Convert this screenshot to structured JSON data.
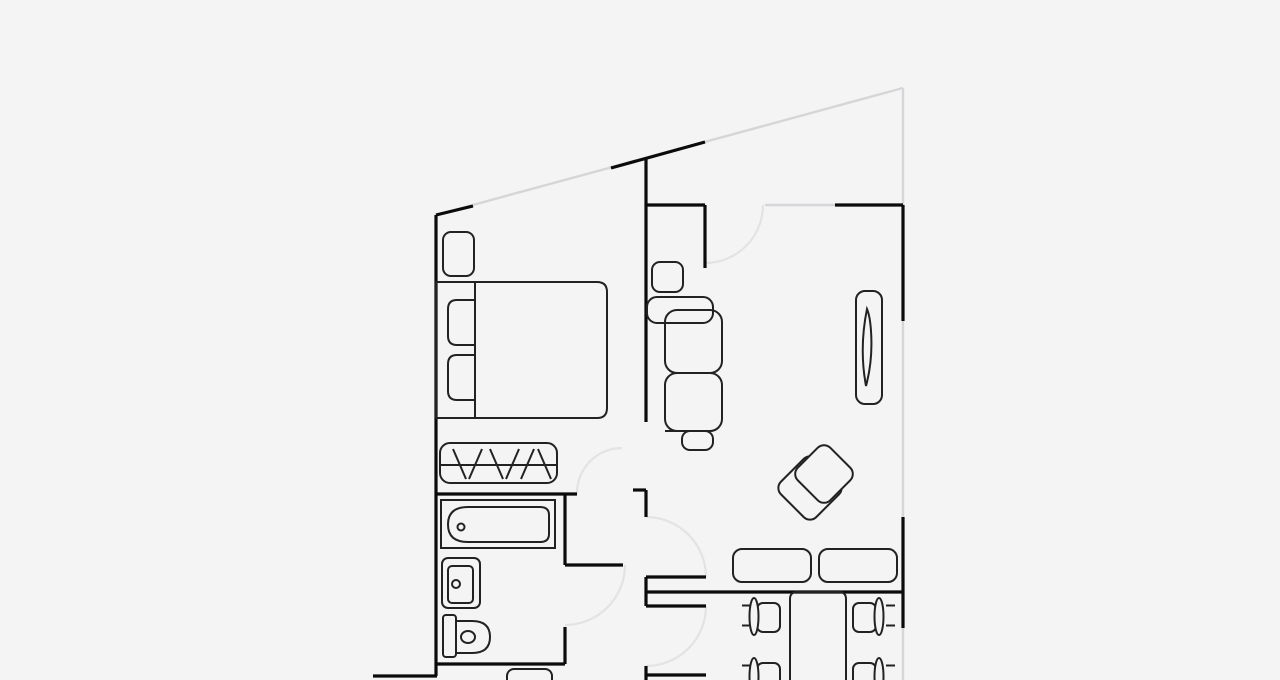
{
  "canvas": {
    "width": 1280,
    "height": 680,
    "background": "#f4f4f5"
  },
  "palette": {
    "wall": "#0b0b0b",
    "furniture": "#222222",
    "window": "#d6d6d9",
    "door_arc": "#e3e3e5",
    "wall_width": 3.2,
    "furniture_width": 2,
    "window_width": 2.4,
    "arc_width": 2.2
  },
  "floorplan": {
    "walls": [
      [
        436,
        215,
        436,
        676
      ],
      [
        373,
        676,
        437,
        676
      ],
      [
        436,
        215,
        473,
        206
      ],
      [
        611,
        168,
        705,
        142
      ],
      [
        646,
        158,
        646,
        422
      ],
      [
        646,
        205,
        705,
        205
      ],
      [
        705,
        205,
        705,
        268
      ],
      [
        835,
        205,
        903,
        205
      ],
      [
        903,
        205,
        903,
        321
      ],
      [
        903,
        517,
        903,
        628
      ],
      [
        436,
        494,
        577,
        494
      ],
      [
        633,
        490,
        646,
        490
      ],
      [
        646,
        490,
        646,
        517
      ],
      [
        565,
        494,
        565,
        565
      ],
      [
        565,
        565,
        623,
        565
      ],
      [
        565,
        627,
        565,
        664
      ],
      [
        436,
        664,
        565,
        664
      ],
      [
        646,
        577,
        646,
        606
      ],
      [
        646,
        577,
        706,
        577
      ],
      [
        646,
        592,
        903,
        592
      ],
      [
        646,
        606,
        706,
        606
      ],
      [
        646,
        666,
        646,
        680
      ],
      [
        646,
        675,
        706,
        675
      ]
    ],
    "windows": [
      [
        436,
        215,
        903,
        88
      ],
      [
        903,
        88,
        903,
        680
      ],
      [
        765,
        205,
        835,
        205
      ]
    ],
    "door_arcs": [
      {
        "name": "bedroom-door-swing",
        "sx": 577,
        "sy": 493,
        "ex": 622,
        "ey": 448,
        "r": 45
      },
      {
        "name": "bathroom-door-swing",
        "sx": 625,
        "sy": 565,
        "ex": 565,
        "ey": 625,
        "r": 60
      },
      {
        "name": "living-room-door-swing",
        "sx": 763,
        "sy": 205,
        "ex": 705,
        "ey": 263,
        "r": 58
      },
      {
        "name": "hall-living-door-swing",
        "sx": 646,
        "sy": 517,
        "ex": 706,
        "ey": 577,
        "r": 60
      },
      {
        "name": "hall-dining-door-swing",
        "sx": 706,
        "sy": 606,
        "ex": 646,
        "ey": 666,
        "r": 60
      }
    ],
    "furniture": [
      {
        "name": "nightstand",
        "shapes": [
          {
            "k": "rect",
            "x": 443,
            "y": 232,
            "w": 31,
            "h": 44,
            "rx": 8
          }
        ]
      },
      {
        "name": "double-bed",
        "shapes": [
          {
            "k": "path",
            "d": "M436 282 H597 Q607 282 607 292 V408 Q607 418 597 418 H436 Z"
          },
          {
            "k": "line",
            "x1": 475,
            "y1": 282,
            "x2": 475,
            "y2": 418
          }
        ]
      },
      {
        "name": "pillow-1",
        "shapes": [
          {
            "k": "path",
            "d": "M475 300 H457 Q448 300 448 309 V336 Q448 345 457 345 H475 Z"
          }
        ]
      },
      {
        "name": "pillow-2",
        "shapes": [
          {
            "k": "path",
            "d": "M475 355 H457 Q448 355 448 364 V391 Q448 400 457 400 H475 Z"
          }
        ]
      },
      {
        "name": "closet-with-hangers",
        "shapes": [
          {
            "k": "rect",
            "x": 440,
            "y": 443,
            "w": 117,
            "h": 40,
            "rx": 10
          },
          {
            "k": "line",
            "x1": 440,
            "y1": 465,
            "x2": 557,
            "y2": 465
          },
          {
            "k": "line",
            "x1": 453,
            "y1": 449,
            "x2": 466,
            "y2": 479
          },
          {
            "k": "line",
            "x1": 482,
            "y1": 449,
            "x2": 469,
            "y2": 479
          },
          {
            "k": "line",
            "x1": 490,
            "y1": 449,
            "x2": 503,
            "y2": 479
          },
          {
            "k": "line",
            "x1": 519,
            "y1": 449,
            "x2": 506,
            "y2": 479
          },
          {
            "k": "line",
            "x1": 534,
            "y1": 449,
            "x2": 521,
            "y2": 479
          },
          {
            "k": "line",
            "x1": 538,
            "y1": 449,
            "x2": 551,
            "y2": 479
          }
        ]
      },
      {
        "name": "bathtub",
        "shapes": [
          {
            "k": "rect",
            "x": 441,
            "y": 500,
            "w": 114,
            "h": 48
          },
          {
            "k": "path",
            "d": "M468 507 H540 Q549 507 549 515 V534 Q549 542 540 542 H468 Q448 542 448 524.5 Q448 507 468 507 Z"
          },
          {
            "k": "circle",
            "cx": 461,
            "cy": 527,
            "r": 3.5
          }
        ]
      },
      {
        "name": "sink",
        "shapes": [
          {
            "k": "rect",
            "x": 442,
            "y": 558,
            "w": 38,
            "h": 50,
            "rx": 6
          },
          {
            "k": "rect",
            "x": 448,
            "y": 566,
            "w": 25,
            "h": 37,
            "rx": 4
          },
          {
            "k": "circle",
            "cx": 456,
            "cy": 584,
            "r": 4
          }
        ]
      },
      {
        "name": "toilet",
        "shapes": [
          {
            "k": "rect",
            "x": 443,
            "y": 615,
            "w": 13,
            "h": 42,
            "rx": 3
          },
          {
            "k": "path",
            "d": "M456 621 H472 Q490 621 490 637 Q490 653 472 653 H456 Z"
          },
          {
            "k": "ellipse",
            "cx": 468,
            "cy": 637,
            "rx": 7,
            "ry": 6
          }
        ]
      },
      {
        "name": "washing-machine",
        "shapes": [
          {
            "k": "rect",
            "x": 507,
            "y": 669,
            "w": 45,
            "h": 25,
            "rx": 7
          }
        ]
      },
      {
        "name": "sofa-side-table",
        "shapes": [
          {
            "k": "rect",
            "x": 652,
            "y": 262,
            "w": 31,
            "h": 30,
            "rx": 8
          }
        ]
      },
      {
        "name": "sofa",
        "shapes": [
          {
            "k": "rect",
            "x": 647,
            "y": 297,
            "w": 66,
            "h": 26,
            "rx": 10
          },
          {
            "k": "rect",
            "x": 665,
            "y": 310,
            "w": 57,
            "h": 63,
            "rx": 12
          },
          {
            "k": "rect",
            "x": 665,
            "y": 373,
            "w": 57,
            "h": 58,
            "rx": 12
          },
          {
            "k": "line",
            "x1": 665,
            "y1": 431,
            "x2": 683,
            "y2": 431
          },
          {
            "k": "rect",
            "x": 682,
            "y": 431,
            "w": 31,
            "h": 19,
            "rx": 8
          }
        ]
      },
      {
        "name": "tv-stand",
        "shapes": [
          {
            "k": "rect",
            "x": 856,
            "y": 291,
            "w": 26,
            "h": 113,
            "rx": 9
          },
          {
            "k": "path",
            "d": "M867 309 Q859 348 866 386 Q873 360 871 331 Q870 316 867 309 Z"
          }
        ]
      },
      {
        "name": "armchair",
        "shapes": [
          {
            "k": "rotrect",
            "cx": 810,
            "cy": 488,
            "w": 50,
            "h": 50,
            "rx": 9,
            "angle": 45
          },
          {
            "k": "rotrect",
            "cx": 824,
            "cy": 474,
            "w": 46,
            "h": 46,
            "rx": 9,
            "angle": 45,
            "fill": "bg"
          }
        ]
      },
      {
        "name": "console-table-1",
        "shapes": [
          {
            "k": "rect",
            "x": 733,
            "y": 549,
            "w": 78,
            "h": 33,
            "rx": 9
          }
        ]
      },
      {
        "name": "console-table-2",
        "shapes": [
          {
            "k": "rect",
            "x": 819,
            "y": 549,
            "w": 78,
            "h": 33,
            "rx": 9
          }
        ]
      },
      {
        "name": "dining-table",
        "shapes": [
          {
            "k": "path",
            "d": "M790 681 V599 Q790 592 797 592 H839 Q846 592 846 599 V681"
          }
        ]
      },
      {
        "name": "dining-chair-1",
        "shapes": [
          {
            "k": "line",
            "x1": 742,
            "y1": 605.5,
            "x2": 751,
            "y2": 605.5
          },
          {
            "k": "line",
            "x1": 742,
            "y1": 625.5,
            "x2": 751,
            "y2": 625.5
          },
          {
            "k": "rect",
            "x": 757,
            "y": 603,
            "w": 23,
            "h": 29,
            "rx": 6
          },
          {
            "k": "ellipse",
            "cx": 754,
            "cy": 616.5,
            "rx": 4.5,
            "ry": 18.5,
            "fill": "bg"
          }
        ]
      },
      {
        "name": "dining-chair-2",
        "shapes": [
          {
            "k": "line",
            "x1": 742,
            "y1": 665.5,
            "x2": 751,
            "y2": 665.5
          },
          {
            "k": "rect",
            "x": 757,
            "y": 663,
            "w": 23,
            "h": 29,
            "rx": 6
          },
          {
            "k": "ellipse",
            "cx": 754,
            "cy": 676.5,
            "rx": 4.5,
            "ry": 18.5,
            "fill": "bg"
          }
        ]
      },
      {
        "name": "dining-chair-3",
        "shapes": [
          {
            "k": "line",
            "x1": 886,
            "y1": 605.5,
            "x2": 895,
            "y2": 605.5
          },
          {
            "k": "line",
            "x1": 886,
            "y1": 625.5,
            "x2": 895,
            "y2": 625.5
          },
          {
            "k": "rect",
            "x": 853,
            "y": 603,
            "w": 23,
            "h": 29,
            "rx": 6
          },
          {
            "k": "ellipse",
            "cx": 879,
            "cy": 616.5,
            "rx": 4.5,
            "ry": 18.5,
            "fill": "bg"
          }
        ]
      },
      {
        "name": "dining-chair-4",
        "shapes": [
          {
            "k": "line",
            "x1": 886,
            "y1": 665.5,
            "x2": 895,
            "y2": 665.5
          },
          {
            "k": "rect",
            "x": 853,
            "y": 663,
            "w": 23,
            "h": 29,
            "rx": 6
          },
          {
            "k": "ellipse",
            "cx": 879,
            "cy": 676.5,
            "rx": 4.5,
            "ry": 18.5,
            "fill": "bg"
          }
        ]
      }
    ]
  }
}
